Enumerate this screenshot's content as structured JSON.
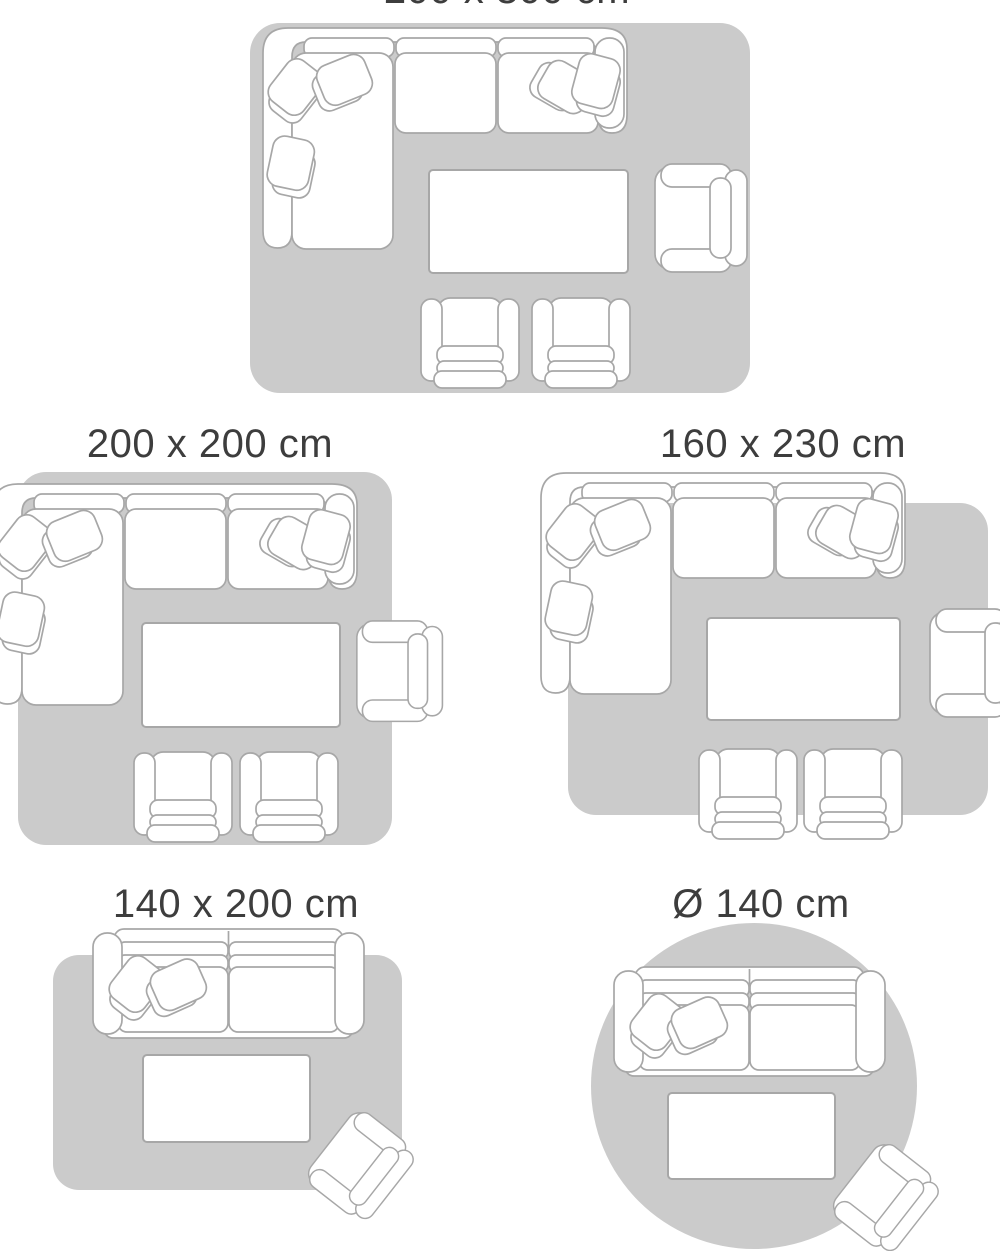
{
  "title": "Rug size guide",
  "colors": {
    "background": "#ffffff",
    "rug": "#cbcbcb",
    "furniture_fill": "#ffffff",
    "furniture_outline": "#a7a7a7",
    "label_text": "#3d3d3d"
  },
  "figures": [
    {
      "id": "rug-200x300",
      "label": "200 x 300 cm",
      "rug_shape": "rectangle",
      "furniture": [
        "corner-sofa",
        "coffee-table",
        "armchair",
        "armchair",
        "armchair"
      ]
    },
    {
      "id": "rug-200x200",
      "label": "200 x 200 cm",
      "rug_shape": "square",
      "furniture": [
        "corner-sofa",
        "coffee-table",
        "armchair",
        "armchair",
        "armchair"
      ]
    },
    {
      "id": "rug-160x230",
      "label": "160 x 230 cm",
      "rug_shape": "rectangle",
      "furniture": [
        "corner-sofa",
        "coffee-table",
        "armchair",
        "armchair",
        "armchair"
      ]
    },
    {
      "id": "rug-140x200",
      "label": "140 x 200 cm",
      "rug_shape": "rectangle",
      "furniture": [
        "two-seater-sofa",
        "coffee-table",
        "armchair"
      ]
    },
    {
      "id": "rug-d140",
      "label": "Ø 140 cm",
      "rug_shape": "circle",
      "furniture": [
        "two-seater-sofa",
        "coffee-table",
        "armchair"
      ]
    }
  ]
}
